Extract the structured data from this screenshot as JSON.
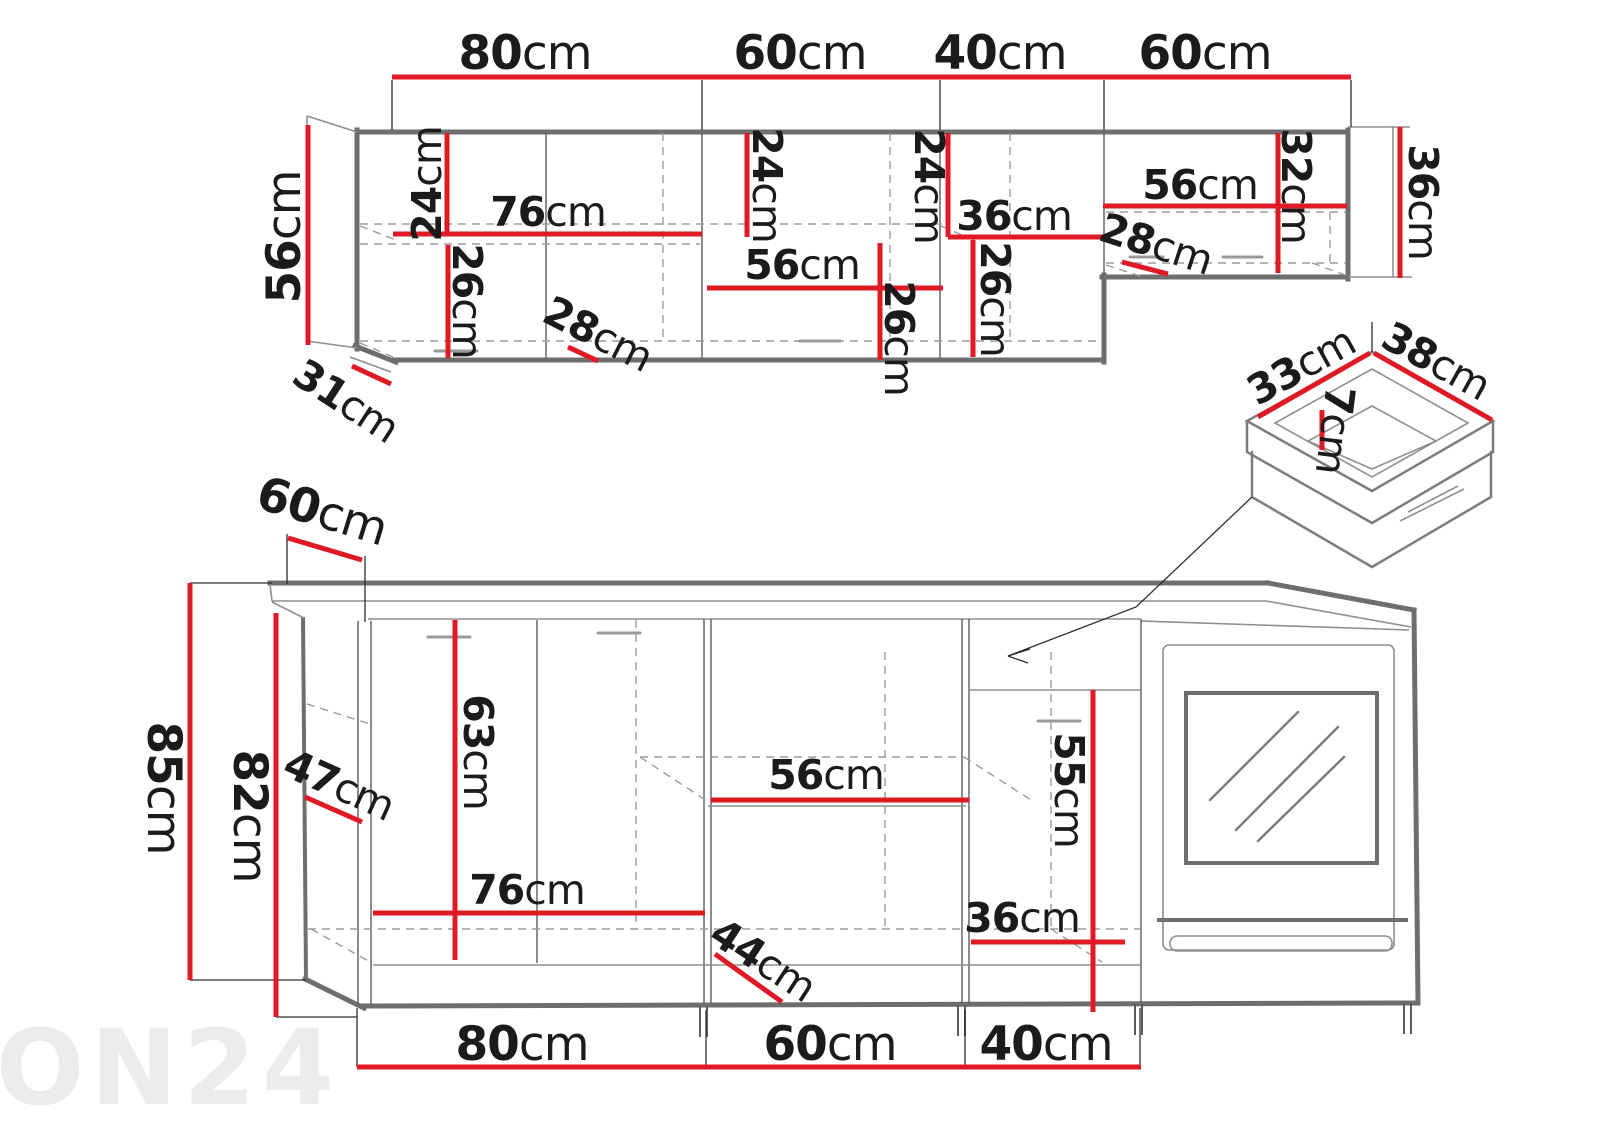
{
  "watermark": "ON24",
  "colors": {
    "red": "#e01a24",
    "cabinet_line": "#6e6e6e",
    "text": "#1b1b1b",
    "dashed": "#9b9b9b",
    "watermark": "#ececec"
  },
  "upper_cabinets": {
    "top_widths": [
      "80cm",
      "60cm",
      "40cm",
      "60cm"
    ],
    "left_height": "56cm",
    "left_depth": "31cm",
    "sec1_top_height": "24cm",
    "sec1_bottom_height": "26cm",
    "sec1_shelf_width": "76cm",
    "sec1_depth": "28cm",
    "sec2_top_height": "24cm",
    "sec2_shelf_width": "56cm",
    "sec2_bottom_height": "26cm",
    "sec3_top_height": "24cm",
    "sec3_shelf_width": "36cm",
    "sec3_bottom_height": "26cm",
    "sec4_shelf_width": "56cm",
    "sec4_inner_height": "32cm",
    "sec4_depth": "28cm",
    "right_height": "36cm"
  },
  "lower_cabinets": {
    "counter_depth": "60cm",
    "total_height": "85cm",
    "carcass_height": "82cm",
    "corner_front_width": "47cm",
    "door_height": "63cm",
    "shelf_width_left": "76cm",
    "front_width": "44cm",
    "shelf_width_mid": "56cm",
    "cabinet_width": "36cm",
    "inner_height": "55cm",
    "bottom_widths": [
      "80cm",
      "60cm",
      "40cm"
    ]
  },
  "drawer_detail": {
    "width": "33cm",
    "depth": "38cm",
    "height": "7cm"
  }
}
